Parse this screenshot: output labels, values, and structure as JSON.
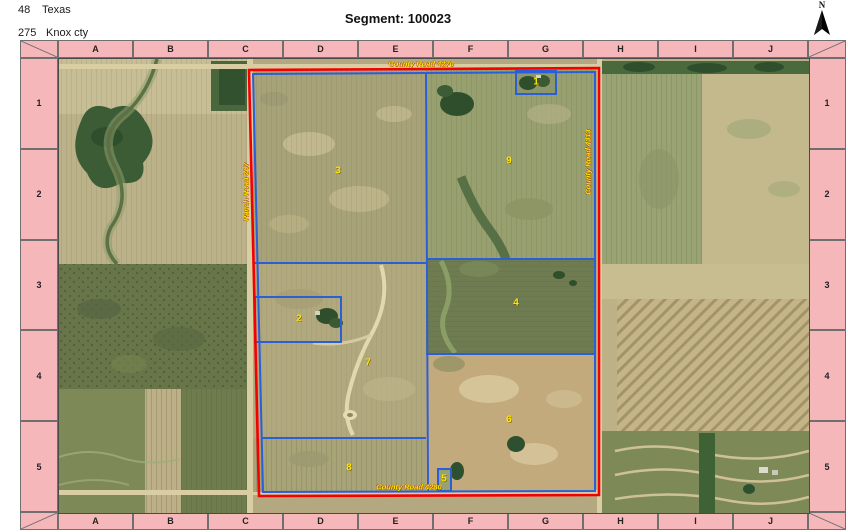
{
  "header": {
    "state_code": "48",
    "state_name": "Texas",
    "county_code": "275",
    "county_name": "Knox cty",
    "title": "Segment: 100023",
    "north_label": "N"
  },
  "grid": {
    "columns": [
      "A",
      "B",
      "C",
      "D",
      "E",
      "F",
      "G",
      "H",
      "I",
      "J"
    ],
    "rows": [
      "1",
      "2",
      "3",
      "4",
      "5"
    ]
  },
  "map": {
    "roads": {
      "top": "County Road 4270",
      "bottom": "County Road 4280",
      "left": "Ranch Road 267",
      "right": "County Road 4313"
    },
    "tracts": [
      {
        "number": "1"
      },
      {
        "number": "2"
      },
      {
        "number": "3"
      },
      {
        "number": "4"
      },
      {
        "number": "5"
      },
      {
        "number": "6"
      },
      {
        "number": "7"
      },
      {
        "number": "8"
      },
      {
        "number": "9"
      }
    ],
    "colors": {
      "segment_boundary": "#f40000",
      "tract_boundary": "#2a5fd7",
      "label_yellow": "#ffe800",
      "grid_header_fill": "#f6b7ba"
    }
  }
}
